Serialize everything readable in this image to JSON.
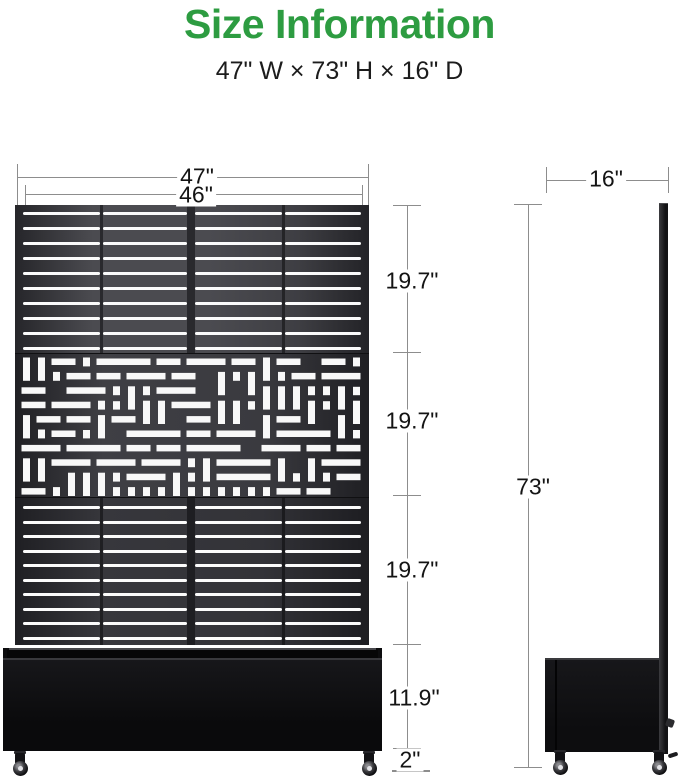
{
  "colors": {
    "accent_green": "#2D9C41",
    "panel_dark": "#3f3f44",
    "dimension_line": "#8d8d8d"
  },
  "header": {
    "title": "Size Information",
    "subtitle": "47\" W × 73\" H × 16\" D"
  },
  "front_view": {
    "overall_width": "47\"",
    "panel_width": "46\"",
    "section_heights": [
      "19.7\"",
      "19.7\"",
      "19.7\""
    ],
    "planter_height": "11.9\"",
    "caster_height": "2\""
  },
  "side_view": {
    "depth": "16\"",
    "overall_height": "73\""
  }
}
